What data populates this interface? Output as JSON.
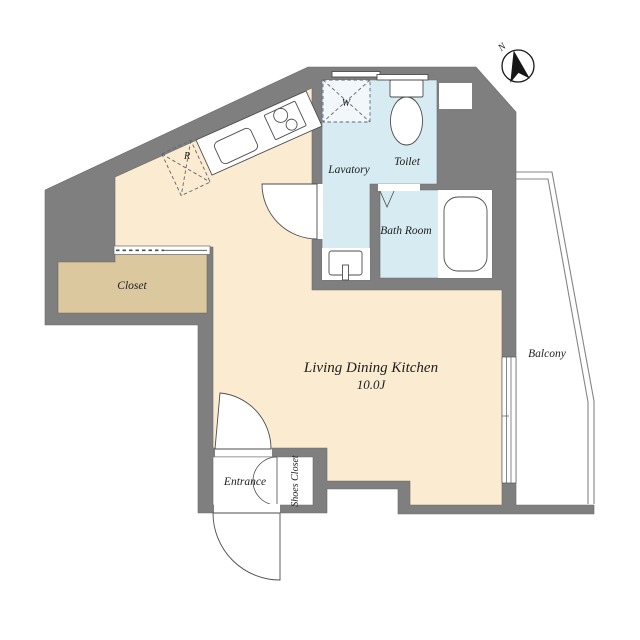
{
  "plan": {
    "rooms": {
      "living_dining_kitchen": {
        "label": "Living Dining Kitchen",
        "area": "10.0J"
      },
      "closet": {
        "label": "Closet"
      },
      "lavatory": {
        "label": "Lavatory"
      },
      "toilet": {
        "label": "Toilet"
      },
      "bath_room": {
        "label": "Bath Room"
      },
      "balcony": {
        "label": "Balcony"
      },
      "entrance": {
        "label": "Entrance"
      },
      "shoes_closet": {
        "label": "Shoes Closet"
      }
    },
    "fixtures": {
      "washer_label": "W",
      "refrigerator_label": "R"
    },
    "compass": {
      "north_label": "N"
    },
    "colors": {
      "wall": "#7f7f7f",
      "floor_main": "#fbecd1",
      "floor_closet": "#dcc89f",
      "floor_wet": "#d7ecf2",
      "outline": "#6b6b6b"
    }
  }
}
